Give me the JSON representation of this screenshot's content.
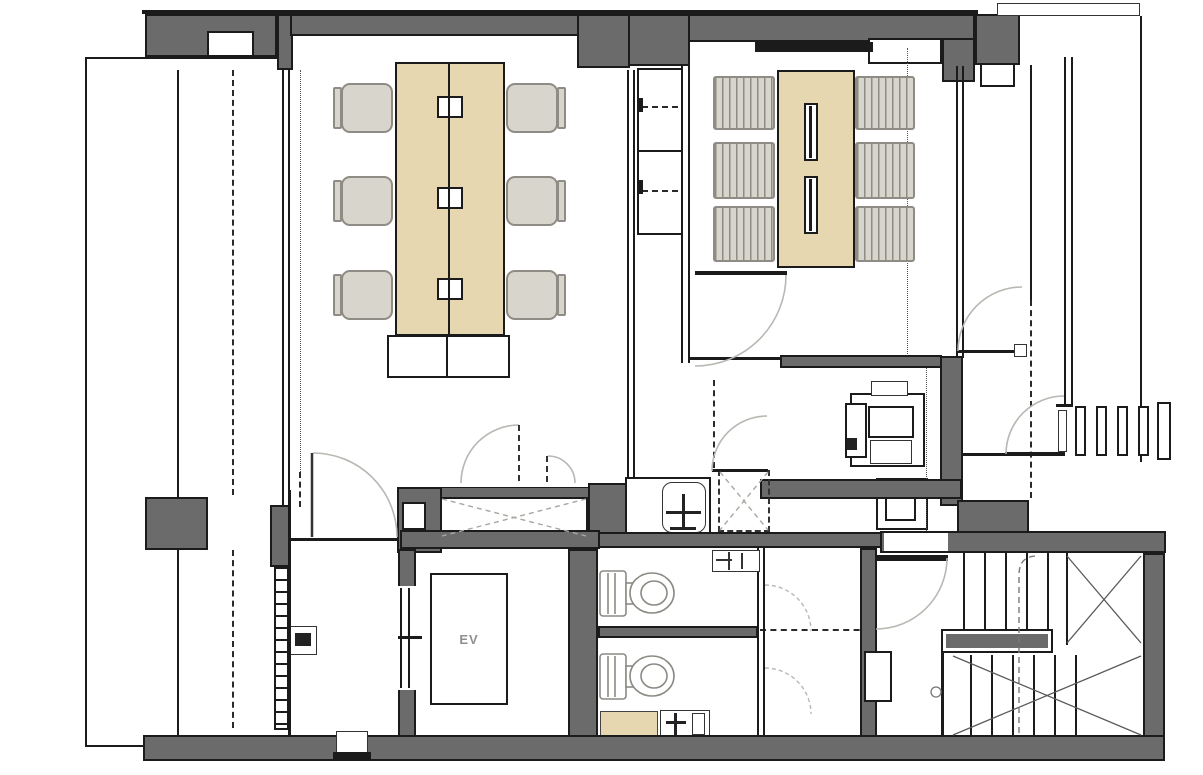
{
  "labels": {
    "elevator": "EV"
  },
  "palette": {
    "background": "#ffffff",
    "wall": "#6b6b6b",
    "line": "#1b1b1b",
    "wood": "#e7d7b1",
    "chair": "#d8d5cd",
    "chair_edge": "#8f8c85",
    "swing": "#b9b7b1"
  },
  "inventory": {
    "meeting_tables": 2,
    "chairs_at_left_table": 6,
    "chairs_at_right_table": 6,
    "wall_cabinet_bays": 2,
    "toilets": 2,
    "wash_basins": 2,
    "elevators": 1,
    "stair_flights": 2,
    "door_swings": 10
  }
}
